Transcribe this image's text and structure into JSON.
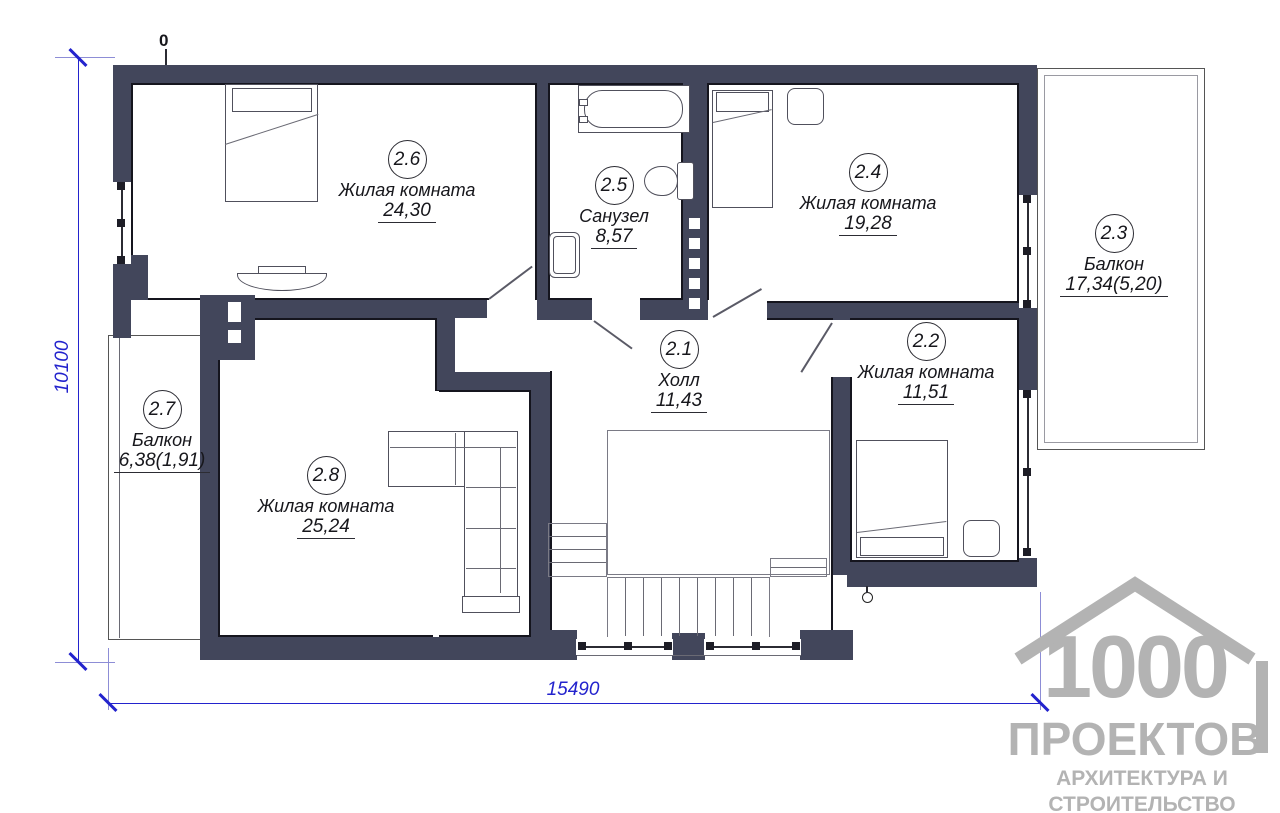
{
  "rooms": [
    {
      "num": "2.1",
      "name": "Холл",
      "area": "11,43"
    },
    {
      "num": "2.2",
      "name": "Жилая комната",
      "area": "11,51"
    },
    {
      "num": "2.3",
      "name": "Балкон",
      "area": "17,34(5,20)"
    },
    {
      "num": "2.4",
      "name": "Жилая комната",
      "area": "19,28"
    },
    {
      "num": "2.5",
      "name": "Санузел",
      "area": "8,57"
    },
    {
      "num": "2.6",
      "name": "Жилая комната",
      "area": "24,30"
    },
    {
      "num": "2.7",
      "name": "Балкон",
      "area": "6,38(1,91)"
    },
    {
      "num": "2.8",
      "name": "Жилая комната",
      "area": "25,24"
    }
  ],
  "dimensions": {
    "horizontal": "15490",
    "vertical": "10100",
    "origin_marker": "0"
  },
  "logo": {
    "number": "1000",
    "word": "ПРОЕКТОВ",
    "tagline1": "АРХИТЕКТУРА И",
    "tagline2": "СТРОИТЕЛЬСТВО"
  },
  "colors": {
    "wall": "#42465B",
    "dimension_blue": "#2323CD",
    "logo_gray": "#B3B3B3"
  }
}
